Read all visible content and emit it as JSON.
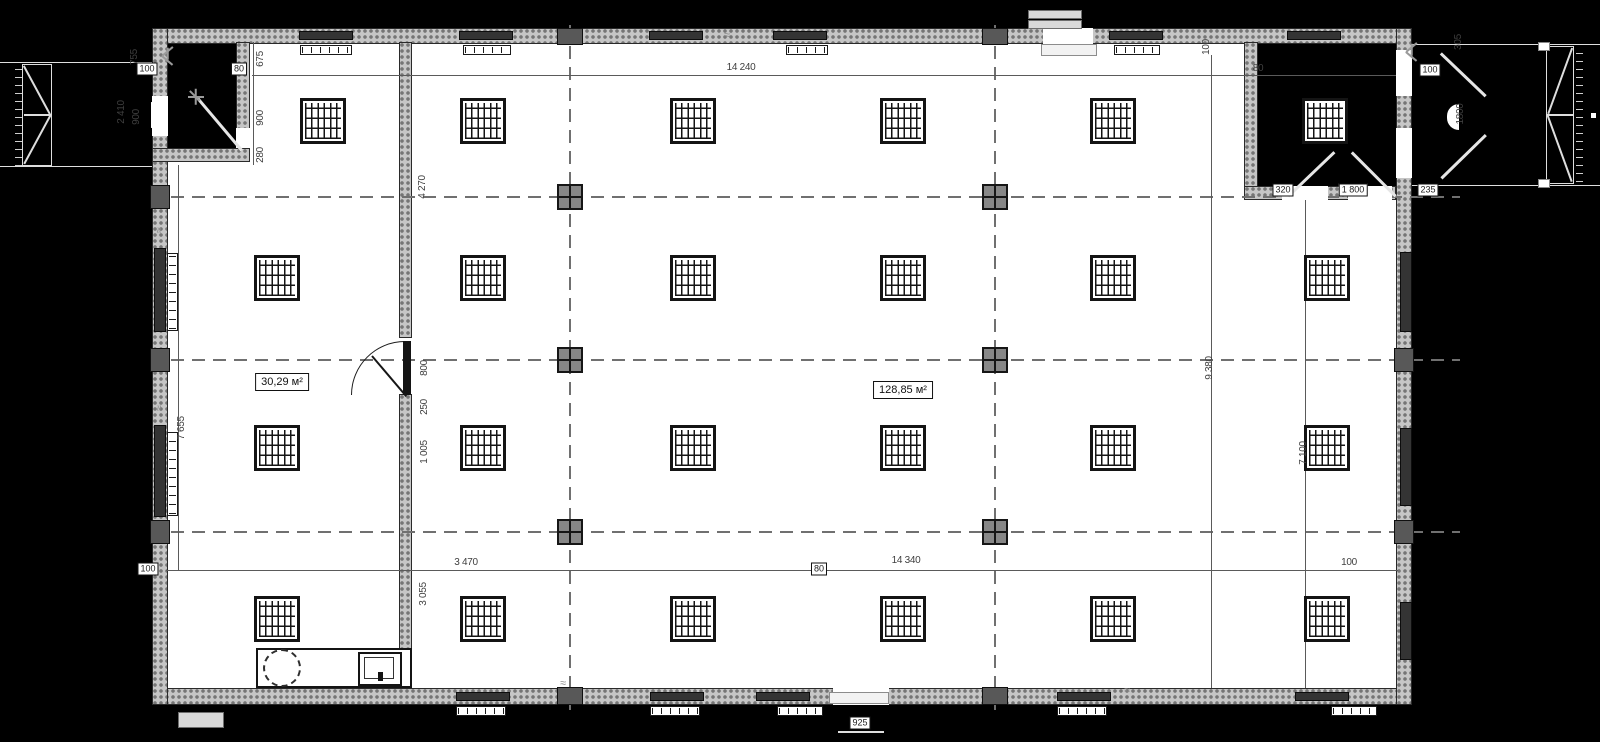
{
  "plan": {
    "areas": {
      "left_room": "30,29 м²",
      "main_hall": "128,85 м²"
    },
    "dims": {
      "top_width": "14 240",
      "top_offset_80": "80",
      "top_offset_80_right": "80",
      "corner_100": "100",
      "tl_755": "755",
      "tl_2410": "2 410",
      "tl_900": "900",
      "chain_675": "675",
      "chain_900": "900",
      "chain_280": "280",
      "int_4270": "4 270",
      "door_800": "800",
      "door_250": "250",
      "door_1005": "1 005",
      "int_3055": "3 055",
      "left_7655": "7 655",
      "bottom_100_left": "100",
      "bottom_3470": "3 470",
      "bottom_80": "80",
      "bottom_width": "14 340",
      "bottom_100_right": "100",
      "right_9380": "9 380",
      "right_7100": "7 100",
      "tr_100_v": "100",
      "tr_100_box": "100",
      "tr_305": "305",
      "tr_1800_v": "1800",
      "tr_320": "320",
      "tr_1800": "1 800",
      "tr_235": "235",
      "step_925": "925"
    },
    "symbols": {
      "wave_mark": "≈"
    },
    "colors": {
      "background": "#000000",
      "paper": "#ffffff",
      "wall_hatch": "#c6c6c6",
      "wall_dot": "#757575",
      "line": "#1c1c1c",
      "dim_text": "#3f3f3f",
      "axis": "#707070",
      "column_marker": "#878787"
    }
  }
}
